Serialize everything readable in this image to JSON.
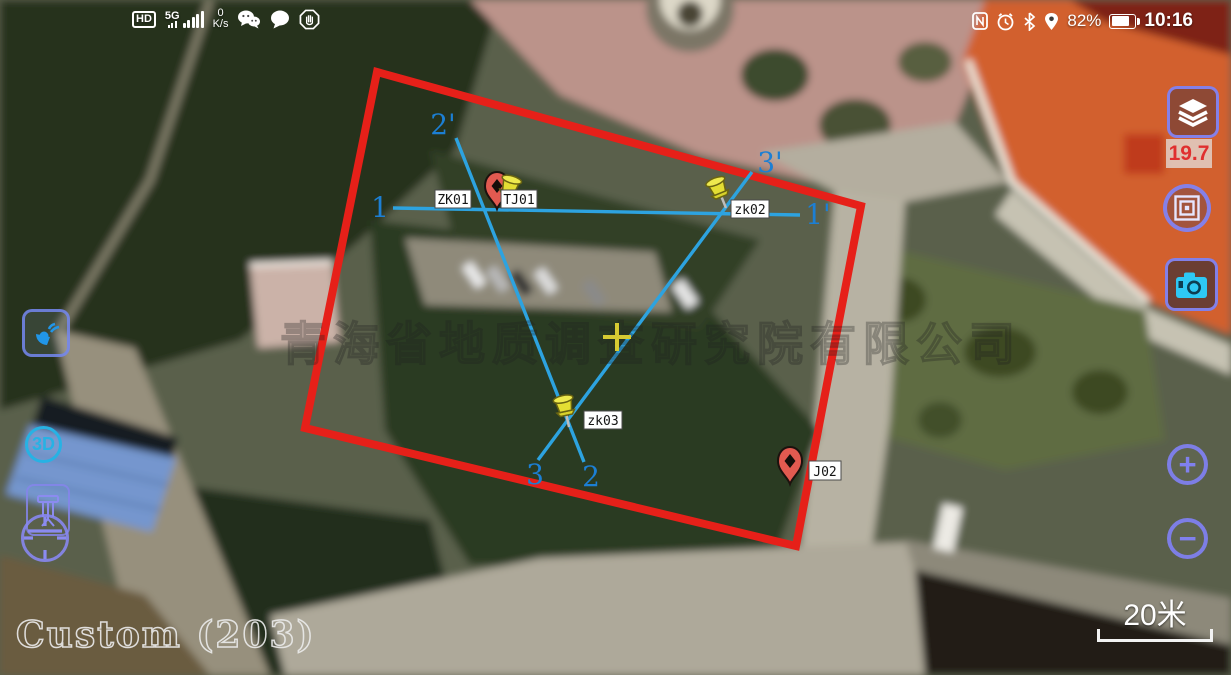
{
  "status_bar": {
    "hd_badge": "HD",
    "network": "5G",
    "data_speed_value": "0",
    "data_speed_unit": "K/s",
    "battery_percent": "82%",
    "time": "10:16"
  },
  "controls": {
    "measure_value": "19.7",
    "three_d_label": "3D",
    "zoom_in_label": "+",
    "zoom_out_label": "−"
  },
  "map": {
    "source_label": "Custom (203)",
    "watermark": "青海省地质调查研究院有限公司",
    "scale_label": "20米",
    "line_labels": {
      "p1": "1",
      "p1_prime": "1'",
      "p2": "2",
      "p2_prime": "2'",
      "p3": "3",
      "p3_prime": "3'"
    },
    "markers": [
      {
        "id": "ZK01",
        "type": "red-pin"
      },
      {
        "id": "TJ01",
        "type": "yellow-pushpin"
      },
      {
        "id": "zk02",
        "type": "yellow-pushpin"
      },
      {
        "id": "zk03",
        "type": "yellow-pushpin"
      },
      {
        "id": "J02",
        "type": "red-pin"
      }
    ]
  }
}
